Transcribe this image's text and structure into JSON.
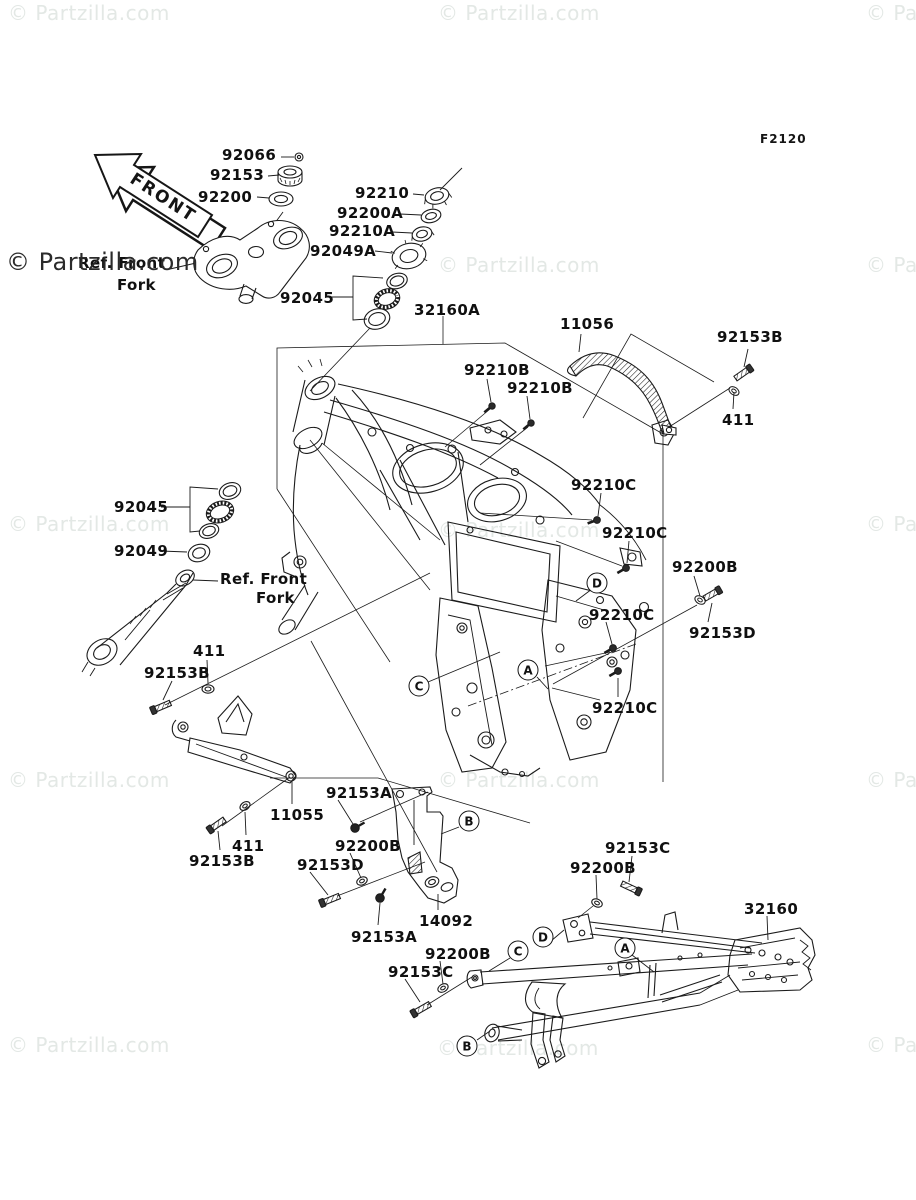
{
  "page": {
    "background": "#ffffff",
    "diagram_code": "F2120"
  },
  "front_arrow": {
    "label": "FRONT"
  },
  "watermark": {
    "text": "© Partzilla.com",
    "light_color": "#e3e8e5",
    "dark_color": "#2b2b2b",
    "tiles": [
      {
        "x": 8,
        "y": 1,
        "variant": "light"
      },
      {
        "x": 438,
        "y": 1,
        "variant": "light"
      },
      {
        "x": 866,
        "y": 1,
        "variant": "light"
      },
      {
        "x": 6,
        "y": 248,
        "variant": "dark"
      },
      {
        "x": 438,
        "y": 253,
        "variant": "light"
      },
      {
        "x": 866,
        "y": 253,
        "variant": "light"
      },
      {
        "x": 8,
        "y": 512,
        "variant": "light"
      },
      {
        "x": 438,
        "y": 518,
        "variant": "light"
      },
      {
        "x": 866,
        "y": 512,
        "variant": "light"
      },
      {
        "x": 8,
        "y": 768,
        "variant": "light"
      },
      {
        "x": 438,
        "y": 768,
        "variant": "light"
      },
      {
        "x": 866,
        "y": 768,
        "variant": "light"
      },
      {
        "x": 8,
        "y": 1033,
        "variant": "light"
      },
      {
        "x": 437,
        "y": 1036,
        "variant": "light"
      },
      {
        "x": 866,
        "y": 1033,
        "variant": "light"
      }
    ]
  },
  "ref_labels": [
    {
      "text": "Ref. Front",
      "x": 78,
      "y": 254
    },
    {
      "text": "Fork",
      "x": 117,
      "y": 276
    },
    {
      "text": "Ref. Front",
      "x": 220,
      "y": 570
    },
    {
      "text": "Fork",
      "x": 256,
      "y": 589
    }
  ],
  "part_labels": [
    {
      "text": "92066",
      "x": 222,
      "y": 146
    },
    {
      "text": "92153",
      "x": 210,
      "y": 166
    },
    {
      "text": "92200",
      "x": 198,
      "y": 188
    },
    {
      "text": "92210",
      "x": 355,
      "y": 184
    },
    {
      "text": "92200A",
      "x": 337,
      "y": 204
    },
    {
      "text": "92210A",
      "x": 329,
      "y": 222
    },
    {
      "text": "92049A",
      "x": 310,
      "y": 242
    },
    {
      "text": "92045",
      "x": 280,
      "y": 289
    },
    {
      "text": "32160A",
      "x": 414,
      "y": 301
    },
    {
      "text": "11056",
      "x": 560,
      "y": 315
    },
    {
      "text": "92153B",
      "x": 717,
      "y": 328
    },
    {
      "text": "411",
      "x": 722,
      "y": 411
    },
    {
      "text": "92210B",
      "x": 464,
      "y": 361
    },
    {
      "text": "92210B",
      "x": 507,
      "y": 379
    },
    {
      "text": "92210C",
      "x": 571,
      "y": 476
    },
    {
      "text": "92210C",
      "x": 602,
      "y": 524
    },
    {
      "text": "92200B",
      "x": 672,
      "y": 558
    },
    {
      "text": "92210C",
      "x": 589,
      "y": 606
    },
    {
      "text": "92153D",
      "x": 689,
      "y": 624
    },
    {
      "text": "92210C",
      "x": 592,
      "y": 699
    },
    {
      "text": "92045",
      "x": 114,
      "y": 498
    },
    {
      "text": "92049",
      "x": 114,
      "y": 542
    },
    {
      "text": "411",
      "x": 193,
      "y": 642
    },
    {
      "text": "92153B",
      "x": 144,
      "y": 664
    },
    {
      "text": "92153A",
      "x": 326,
      "y": 784
    },
    {
      "text": "11055",
      "x": 270,
      "y": 806
    },
    {
      "text": "92200B",
      "x": 335,
      "y": 837
    },
    {
      "text": "411",
      "x": 232,
      "y": 837
    },
    {
      "text": "92153D",
      "x": 297,
      "y": 856
    },
    {
      "text": "92153B",
      "x": 189,
      "y": 852
    },
    {
      "text": "14092",
      "x": 419,
      "y": 912
    },
    {
      "text": "92153A",
      "x": 351,
      "y": 928
    },
    {
      "text": "92200B",
      "x": 425,
      "y": 945
    },
    {
      "text": "92153C",
      "x": 388,
      "y": 963
    },
    {
      "text": "92153C",
      "x": 605,
      "y": 839
    },
    {
      "text": "92200B",
      "x": 570,
      "y": 859
    },
    {
      "text": "32160",
      "x": 744,
      "y": 900
    }
  ],
  "callouts": [
    {
      "letter": "C",
      "x": 419,
      "y": 686
    },
    {
      "letter": "A",
      "x": 528,
      "y": 670
    },
    {
      "letter": "D",
      "x": 597,
      "y": 583
    },
    {
      "letter": "B",
      "x": 469,
      "y": 821
    },
    {
      "letter": "C",
      "x": 518,
      "y": 951
    },
    {
      "letter": "D",
      "x": 543,
      "y": 937
    },
    {
      "letter": "A",
      "x": 625,
      "y": 948
    },
    {
      "letter": "B",
      "x": 467,
      "y": 1046
    }
  ],
  "line_color": "#1b1b1b"
}
